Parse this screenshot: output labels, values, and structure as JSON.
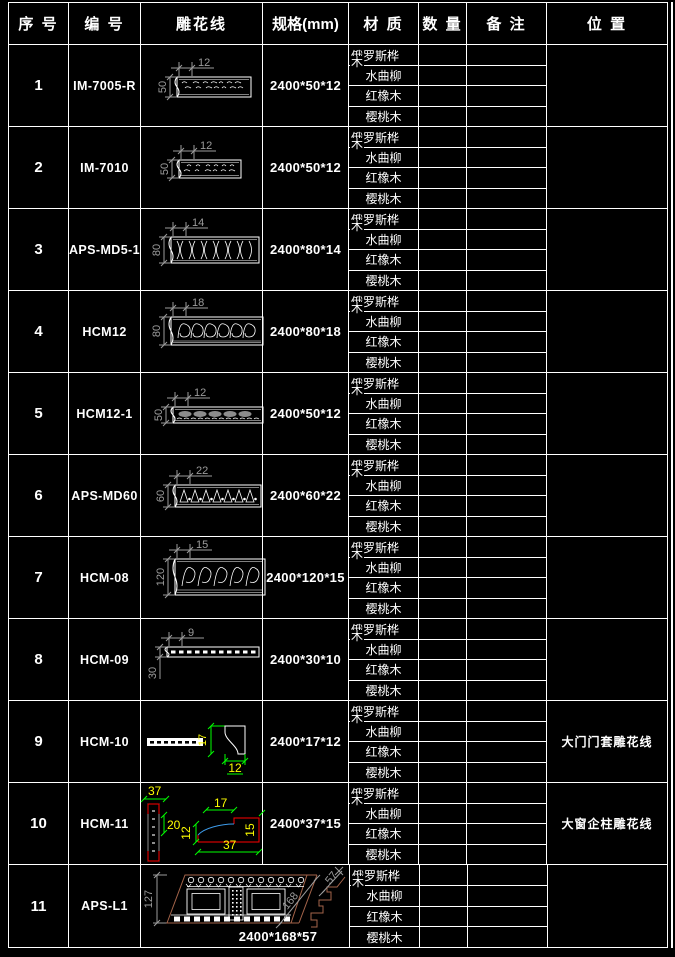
{
  "header": {
    "cols": [
      "序 号",
      "编 号",
      "雕花线",
      "规格(mm)",
      "材 质",
      "数 量",
      "备 注",
      "位 置"
    ]
  },
  "materials": [
    "俄罗斯桦木",
    "水曲柳",
    "红橡木",
    "樱桃木"
  ],
  "colors": {
    "line": "#ffffff",
    "dim": "#9c9c9c",
    "green": "#00ff00",
    "yellow": "#ffff00",
    "red": "#ff0000",
    "blue": "#3d9be9",
    "brown": "#a4644a",
    "gray": "#8c8c8c"
  },
  "rows": [
    {
      "seq": "1",
      "code": "IM-7005-R",
      "spec": "2400*50*12",
      "position": "",
      "dims": {
        "top": "12",
        "left": "50"
      },
      "draw": {
        "type": "strip",
        "x": 36,
        "y": 32,
        "w": 74,
        "h": 20,
        "pat": "pebble"
      }
    },
    {
      "seq": "2",
      "code": "IM-7010",
      "spec": "2400*50*12",
      "position": "",
      "dims": {
        "top": "12",
        "left": "50"
      },
      "draw": {
        "type": "strip",
        "x": 38,
        "y": 33,
        "w": 62,
        "h": 18,
        "pat": "pebble"
      }
    },
    {
      "seq": "3",
      "code": "APS-MD5-1",
      "spec": "2400*80*14",
      "position": "",
      "dims": {
        "top": "14",
        "left": "80"
      },
      "draw": {
        "type": "strip",
        "x": 30,
        "y": 28,
        "w": 88,
        "h": 26,
        "pat": "floral"
      }
    },
    {
      "seq": "4",
      "code": "HCM12",
      "spec": "2400*80*18",
      "position": "",
      "dims": {
        "top": "18",
        "left": "80"
      },
      "draw": {
        "type": "strip",
        "x": 30,
        "y": 26,
        "w": 92,
        "h": 28,
        "pat": "scroll"
      }
    },
    {
      "seq": "5",
      "code": "HCM12-1",
      "spec": "2400*50*12",
      "position": "",
      "dims": {
        "top": "12",
        "left": "50"
      },
      "draw": {
        "type": "strip",
        "x": 32,
        "y": 34,
        "w": 90,
        "h": 16,
        "pat": "grayblob"
      }
    },
    {
      "seq": "6",
      "code": "APS-MD60",
      "spec": "2400*60*22",
      "position": "",
      "dims": {
        "top": "22",
        "left": "60"
      },
      "draw": {
        "type": "strip",
        "x": 34,
        "y": 30,
        "w": 86,
        "h": 22,
        "pat": "eggdart"
      }
    },
    {
      "seq": "7",
      "code": "HCM-08",
      "spec": "2400*120*15",
      "position": "",
      "dims": {
        "top": "15",
        "left": "120"
      },
      "draw": {
        "type": "strip",
        "x": 34,
        "y": 22,
        "w": 90,
        "h": 36,
        "pat": "floral2"
      }
    },
    {
      "seq": "8",
      "code": "HCM-09",
      "spec": "2400*30*10",
      "position": "",
      "dims": {
        "top": "9",
        "left": "30"
      },
      "draw": {
        "type": "strip",
        "x": 26,
        "y": 28,
        "w": 92,
        "h": 10,
        "pat": "dash"
      }
    },
    {
      "seq": "9",
      "code": "HCM-10",
      "spec": "2400*17*12",
      "position": "大门门套雕花线",
      "dims": {
        "height": "17",
        "width": "12"
      },
      "draw": {
        "type": "hcm10"
      }
    },
    {
      "seq": "10",
      "code": "HCM-11",
      "spec": "2400*37*15",
      "position": "大窗企柱雕花线",
      "dims": {
        "top": "37",
        "side": "20",
        "step": "17",
        "left": "12",
        "bottom": "37",
        "right": "15"
      },
      "draw": {
        "type": "hcm11"
      }
    },
    {
      "seq": "11",
      "code": "APS-L1",
      "spec": "2400*168*57",
      "position": "",
      "merged": true,
      "dims": {
        "left": "127",
        "diag": "168",
        "diag2": "57"
      },
      "draw": {
        "type": "crown"
      }
    }
  ]
}
